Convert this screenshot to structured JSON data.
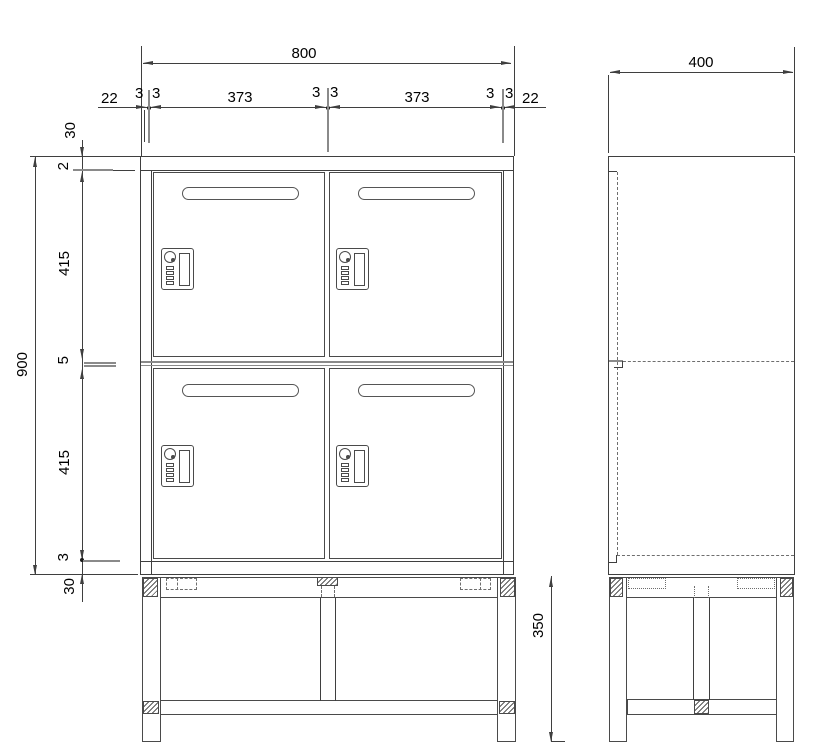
{
  "drawing": {
    "type": "technical-drawing",
    "subject": "four-door locker cabinet on stand, front and side elevation",
    "front_view": {
      "overall_width": "800",
      "overall_height": "900",
      "width_chain": [
        "22",
        "3",
        "3",
        "373",
        "3",
        "3",
        "373",
        "3",
        "3",
        "22"
      ],
      "height_chain": [
        "30",
        "2",
        "415",
        "5",
        "415",
        "3",
        "30"
      ]
    },
    "side_view": {
      "overall_depth": "400",
      "stand_height": "350"
    },
    "colors": {
      "line": "#3f3f3f",
      "light_line": "#8a8a8a",
      "text": "#000000",
      "background": "#ffffff"
    }
  }
}
